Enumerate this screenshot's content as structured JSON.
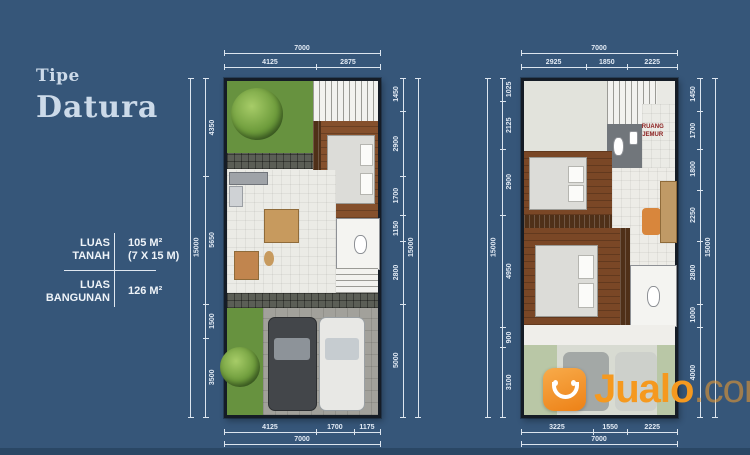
{
  "colors": {
    "background": "#365679",
    "accent_orange": "#f5991f",
    "room_label_red": "#8a1c1c"
  },
  "title": {
    "tipe": "Tipe",
    "name": "Datura"
  },
  "specs": {
    "tanah": {
      "label_line1": "LUAS",
      "label_line2": "TANAH",
      "area": "105 M²",
      "dimensions": "(7 X 15 M)"
    },
    "bangunan": {
      "label_line1": "LUAS",
      "label_line2": "BANGUNAN",
      "area": "126 M²"
    }
  },
  "plans": [
    {
      "name": "ground-floor",
      "dims": {
        "top_total": "7000",
        "top": [
          "4125",
          "2875"
        ],
        "left_total": "15000",
        "left": [
          "4350",
          "5650",
          "1500",
          "3500"
        ],
        "right_total": "15000",
        "right": [
          "1450",
          "2900",
          "1700",
          "1150",
          "2800",
          "5000"
        ],
        "bottom": [
          "4125",
          "1700",
          "1175"
        ],
        "bottom_total": "7000"
      }
    },
    {
      "name": "upper-floor",
      "room_label": "RUANG JEMUR",
      "dims": {
        "top_total": "7000",
        "top": [
          "2925",
          "1850",
          "2225"
        ],
        "left_total": "15000",
        "left": [
          "1025",
          "2125",
          "2900",
          "4950",
          "900",
          "3100"
        ],
        "right_total": "15000",
        "right": [
          "1450",
          "1700",
          "1800",
          "2250",
          "2800",
          "1000",
          "4000"
        ],
        "bottom": [
          "3225",
          "1550",
          "2225"
        ],
        "bottom_total": "7000"
      }
    }
  ],
  "watermark": {
    "brand": "Jualo",
    "suffix": ".com"
  }
}
